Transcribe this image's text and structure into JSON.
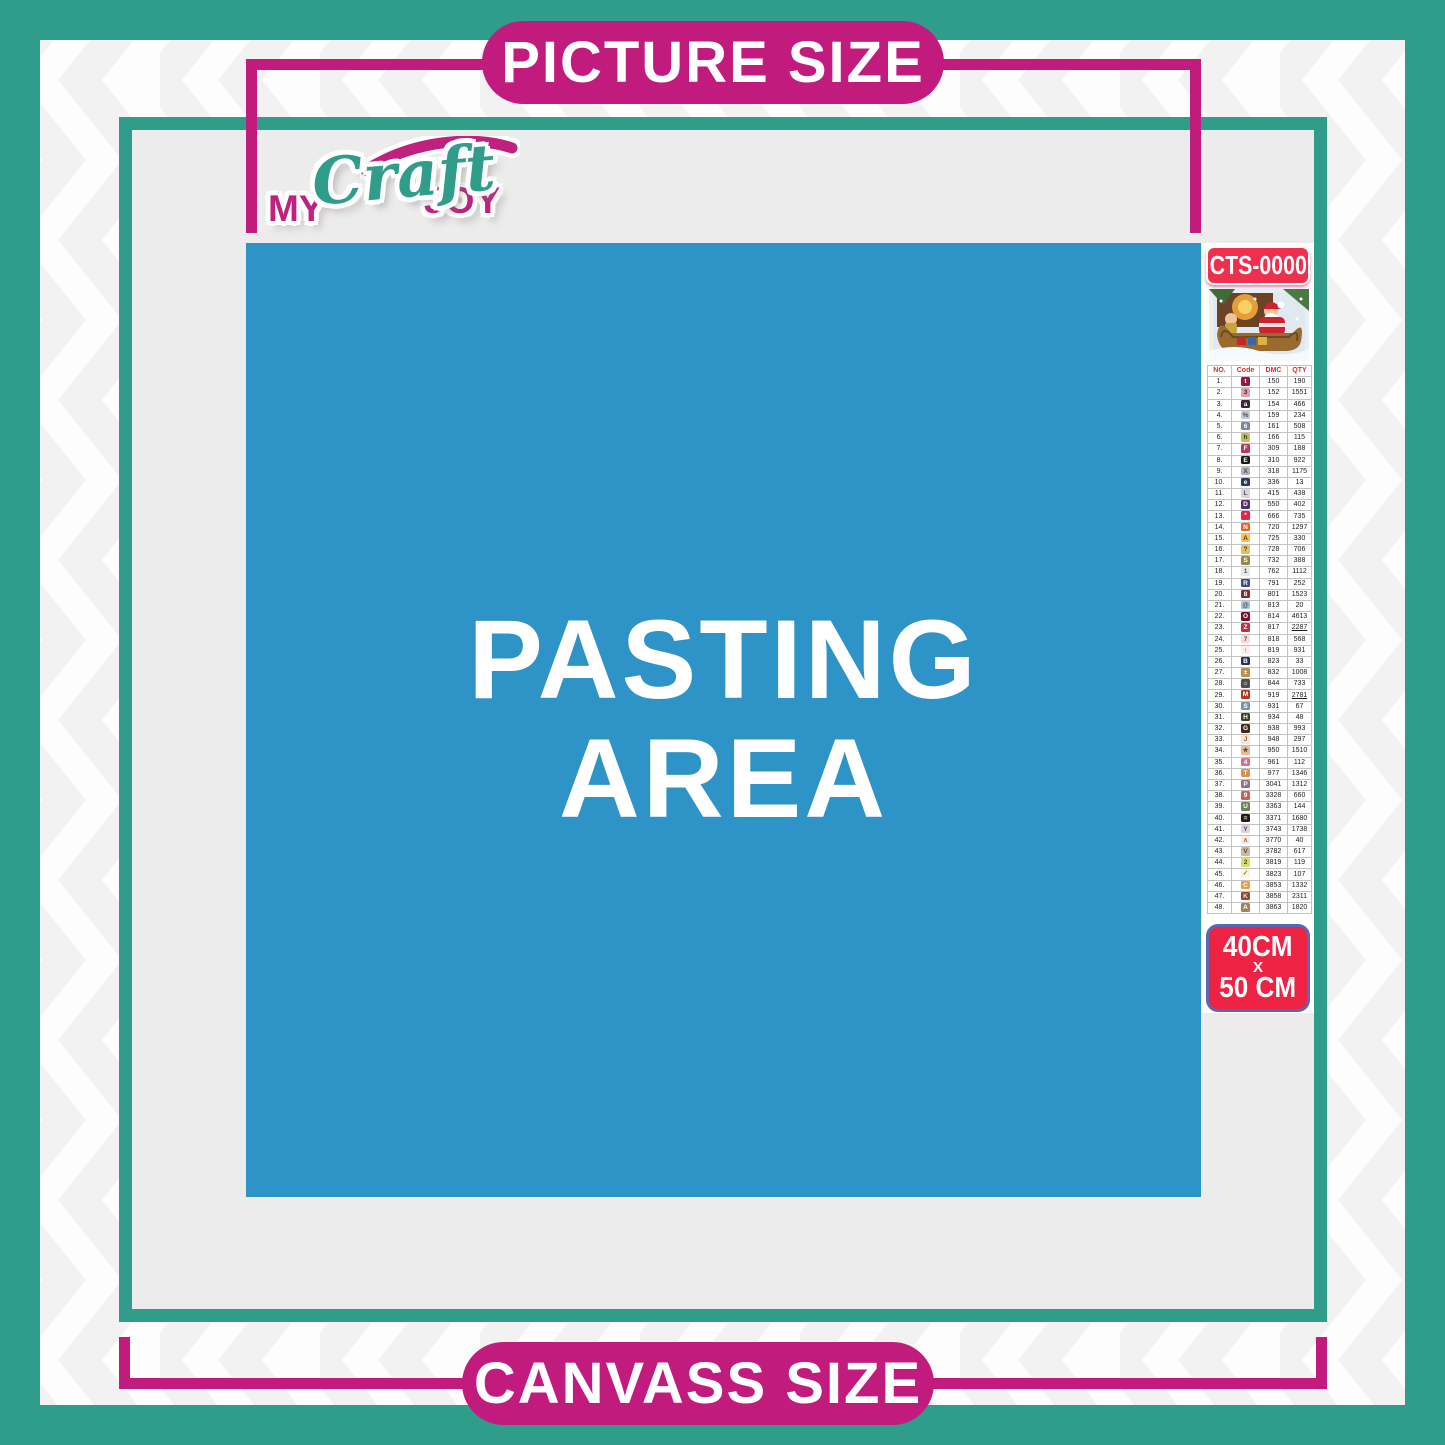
{
  "page": {
    "top_label": "PICTURE SIZE",
    "bottom_label": "CANVASS SIZE"
  },
  "logo": {
    "word1": "MY",
    "word2": "Craft",
    "word3": "JOY"
  },
  "pasting_area": {
    "line1": "PASTING",
    "line2": "AREA"
  },
  "sidebar": {
    "sku": "CTS-0000",
    "preview_image": "christmas-santa-sleigh-scene",
    "size": {
      "line1": "40CM",
      "line2": "X",
      "line3": "50 CM"
    },
    "table": {
      "headers": [
        "NO.",
        "Code",
        "DMC",
        "QTY"
      ],
      "rows": [
        {
          "no": "1.",
          "sym": "t",
          "bg": "#9e1543",
          "fg": "#ffffff",
          "dmc": "150",
          "qty": "190"
        },
        {
          "no": "2.",
          "sym": "3",
          "bg": "#dfa1ab",
          "fg": "#44232b",
          "dmc": "152",
          "qty": "1551"
        },
        {
          "no": "3.",
          "sym": "a",
          "bg": "#3f2838",
          "fg": "#ffffff",
          "dmc": "154",
          "qty": "466"
        },
        {
          "no": "4.",
          "sym": "%",
          "bg": "#c3c8d8",
          "fg": "#4a4e62",
          "dmc": "159",
          "qty": "234"
        },
        {
          "no": "5.",
          "sym": "6",
          "bg": "#7b84ab",
          "fg": "#ffffff",
          "dmc": "161",
          "qty": "508"
        },
        {
          "no": "6.",
          "sym": "h",
          "bg": "#bfc24d",
          "fg": "#3b3c13",
          "dmc": "166",
          "qty": "115"
        },
        {
          "no": "7.",
          "sym": "F",
          "bg": "#bc3758",
          "fg": "#ffffff",
          "dmc": "309",
          "qty": "188"
        },
        {
          "no": "8.",
          "sym": "E",
          "bg": "#1b1b1b",
          "fg": "#ffffff",
          "dmc": "310",
          "qty": "922"
        },
        {
          "no": "9.",
          "sym": "X",
          "bg": "#b3b4b8",
          "fg": "#4c4c4e",
          "dmc": "318",
          "qty": "1175"
        },
        {
          "no": "10.",
          "sym": "e",
          "bg": "#2a3a60",
          "fg": "#ffffff",
          "dmc": "336",
          "qty": "13"
        },
        {
          "no": "11.",
          "sym": "L",
          "bg": "#d6d7db",
          "fg": "#55565c",
          "dmc": "415",
          "qty": "438"
        },
        {
          "no": "12.",
          "sym": "D",
          "bg": "#54306b",
          "fg": "#ffffff",
          "dmc": "550",
          "qty": "402"
        },
        {
          "no": "13.",
          "sym": "*",
          "bg": "#e02947",
          "fg": "#ffffff",
          "dmc": "666",
          "qty": "735"
        },
        {
          "no": "14.",
          "sym": "N",
          "bg": "#e66426",
          "fg": "#ffffff",
          "dmc": "720",
          "qty": "1297"
        },
        {
          "no": "15.",
          "sym": "A",
          "bg": "#f5c054",
          "fg": "#5a3a00",
          "dmc": "725",
          "qty": "330"
        },
        {
          "no": "16.",
          "sym": "?",
          "bg": "#e9bc6a",
          "fg": "#5a3a00",
          "dmc": "728",
          "qty": "706"
        },
        {
          "no": "17.",
          "sym": "S",
          "bg": "#98894a",
          "fg": "#ffffff",
          "dmc": "732",
          "qty": "388"
        },
        {
          "no": "18.",
          "sym": "1",
          "bg": "#e8e9eb",
          "fg": "#555555",
          "dmc": "762",
          "qty": "1112"
        },
        {
          "no": "19.",
          "sym": "R",
          "bg": "#3c4c8c",
          "fg": "#ffffff",
          "dmc": "791",
          "qty": "252"
        },
        {
          "no": "20.",
          "sym": "8",
          "bg": "#7c3028",
          "fg": "#ffffff",
          "dmc": "801",
          "qty": "1523"
        },
        {
          "no": "21.",
          "sym": "@",
          "bg": "#a9c4da",
          "fg": "#3f5366",
          "dmc": "813",
          "qty": "20"
        },
        {
          "no": "22.",
          "sym": "O",
          "bg": "#761327",
          "fg": "#ffffff",
          "dmc": "814",
          "qty": "4613"
        },
        {
          "no": "23.",
          "sym": "Z",
          "bg": "#c62f3e",
          "fg": "#ffffff",
          "dmc": "817",
          "qty": "2287",
          "u": true
        },
        {
          "no": "24.",
          "sym": "7",
          "bg": "#f8dcd9",
          "fg": "#6b4a46",
          "dmc": "818",
          "qty": "568"
        },
        {
          "no": "25.",
          "sym": "↑",
          "bg": "#fbeee9",
          "fg": "#6b4a46",
          "dmc": "819",
          "qty": "931"
        },
        {
          "no": "26.",
          "sym": "B",
          "bg": "#24305e",
          "fg": "#ffffff",
          "dmc": "823",
          "qty": "33"
        },
        {
          "no": "27.",
          "sym": "±",
          "bg": "#b3914f",
          "fg": "#ffffff",
          "dmc": "832",
          "qty": "1008"
        },
        {
          "no": "28.",
          "sym": "☼",
          "bg": "#4f4f4f",
          "fg": "#ffffff",
          "dmc": "844",
          "qty": "733"
        },
        {
          "no": "29.",
          "sym": "M",
          "bg": "#b23c20",
          "fg": "#ffffff",
          "dmc": "919",
          "qty": "2781",
          "u": true
        },
        {
          "no": "30.",
          "sym": "S",
          "bg": "#7492ab",
          "fg": "#ffffff",
          "dmc": "931",
          "qty": "67"
        },
        {
          "no": "31.",
          "sym": "H",
          "bg": "#3c4426",
          "fg": "#ffffff",
          "dmc": "934",
          "qty": "48"
        },
        {
          "no": "32.",
          "sym": "G",
          "bg": "#452a1a",
          "fg": "#ffffff",
          "dmc": "938",
          "qty": "993"
        },
        {
          "no": "33.",
          "sym": "J",
          "bg": "#fbe3d0",
          "fg": "#8a5a3a",
          "dmc": "948",
          "qty": "297"
        },
        {
          "no": "34.",
          "sym": "★",
          "bg": "#e5bb9a",
          "fg": "#6b4a2a",
          "dmc": "950",
          "qty": "1510"
        },
        {
          "no": "35.",
          "sym": "4",
          "bg": "#d3718d",
          "fg": "#ffffff",
          "dmc": "961",
          "qty": "112"
        },
        {
          "no": "36.",
          "sym": "T",
          "bg": "#d89050",
          "fg": "#ffffff",
          "dmc": "977",
          "qty": "1346"
        },
        {
          "no": "37.",
          "sym": "P",
          "bg": "#93707f",
          "fg": "#ffffff",
          "dmc": "3041",
          "qty": "1312"
        },
        {
          "no": "38.",
          "sym": "9",
          "bg": "#cc6254",
          "fg": "#ffffff",
          "dmc": "3328",
          "qty": "660"
        },
        {
          "no": "39.",
          "sym": "U",
          "bg": "#6d8458",
          "fg": "#ffffff",
          "dmc": "3363",
          "qty": "144"
        },
        {
          "no": "40.",
          "sym": "=",
          "bg": "#2a1a10",
          "fg": "#ffffff",
          "dmc": "3371",
          "qty": "1680"
        },
        {
          "no": "41.",
          "sym": "Y",
          "bg": "#dcd3dc",
          "fg": "#5a4a5a",
          "dmc": "3743",
          "qty": "1738"
        },
        {
          "no": "42.",
          "sym": "∧",
          "bg": "#fcebdc",
          "fg": "#8a6a4a",
          "dmc": "3770",
          "qty": "40"
        },
        {
          "no": "43.",
          "sym": "V",
          "bg": "#cdb89f",
          "fg": "#564733",
          "dmc": "3782",
          "qty": "617"
        },
        {
          "no": "44.",
          "sym": "2",
          "bg": "#dade67",
          "fg": "#4c4f13",
          "dmc": "3819",
          "qty": "119"
        },
        {
          "no": "45.",
          "sym": "✓",
          "bg": "#fdf6d7",
          "fg": "#8a7a3a",
          "dmc": "3823",
          "qty": "107"
        },
        {
          "no": "46.",
          "sym": "C",
          "bg": "#f09a43",
          "fg": "#ffffff",
          "dmc": "3853",
          "qty": "1332"
        },
        {
          "no": "47.",
          "sym": "K",
          "bg": "#8d4a37",
          "fg": "#ffd9c0",
          "dmc": "3858",
          "qty": "2311"
        },
        {
          "no": "48.",
          "sym": "A",
          "bg": "#a08359",
          "fg": "#ffffff",
          "dmc": "3863",
          "qty": "1820"
        }
      ]
    }
  },
  "colors": {
    "teal": "#2f9d89",
    "magenta": "#c11b7e",
    "pasting_blue": "#2e93c6",
    "canvas_gray": "#ececec",
    "label_red": "#ee2f4e",
    "size_border_blue": "#5a68b2",
    "table_header_red": "#d42f2f"
  }
}
